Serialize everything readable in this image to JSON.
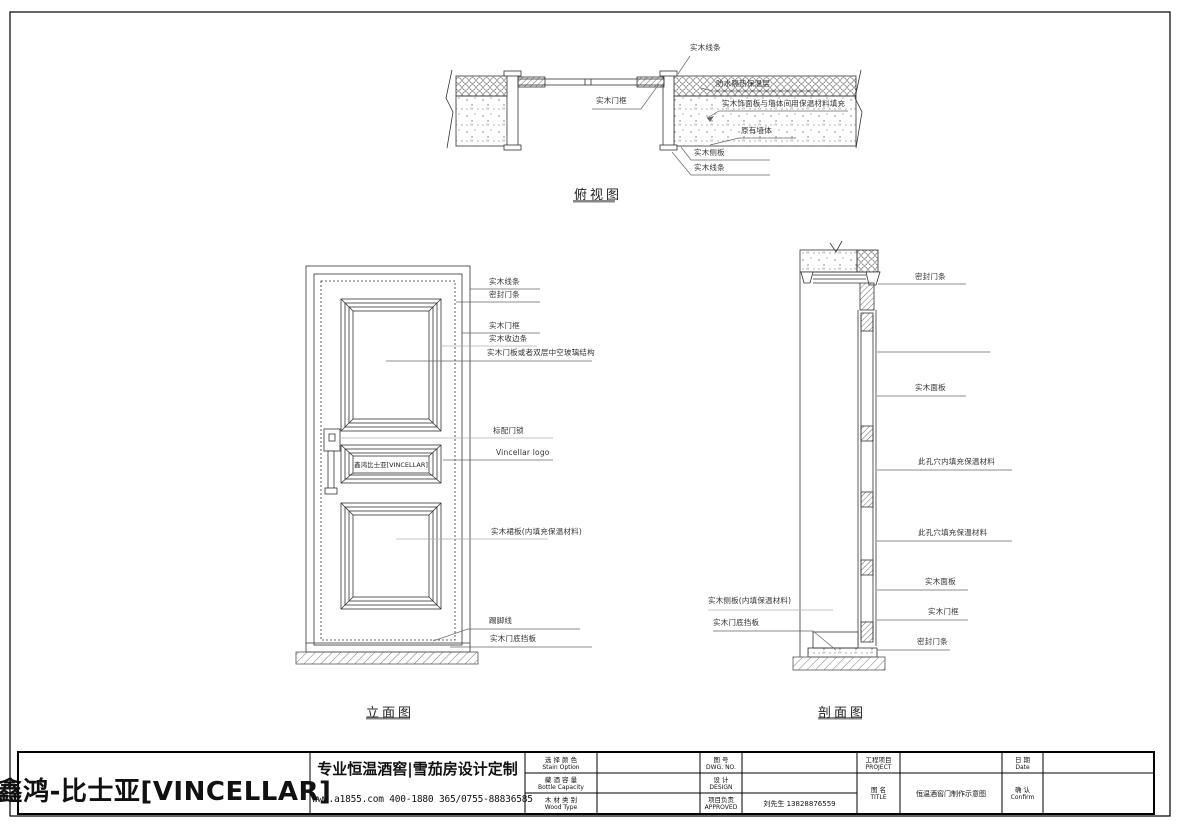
{
  "top_view": {
    "title": "俯视图",
    "labels": {
      "trim_top": "实木线条",
      "waterproof_insulation": "防水隔热保温层",
      "panel_gap_fill": "实木饰面板与墙体间用保温材料填充",
      "original_wall": "原有墙体",
      "side_panel": "实木侧板",
      "trim_bottom": "实木线条",
      "door_frame": "实木门框"
    }
  },
  "elevation": {
    "title": "立面图",
    "door_logo": "鑫鸿比士亚[VINCELLAR]",
    "labels": {
      "trim": "实木线条",
      "seal_strip": "密封门条",
      "door_frame": "实木门框",
      "edge_trim": "实木收边条",
      "panel_or_glass": "实木门板或者双层中空玻璃结构",
      "lock": "标配门锁",
      "logo": "Vincellar logo",
      "lower_panel": "实木裙板(内填充保温材料)",
      "skirting": "踢脚线",
      "bottom_board": "实木门底挡板"
    }
  },
  "section": {
    "title": "剖面图",
    "labels": {
      "seal_strip_top": "密封门条",
      "face_panel_top": "实木面板",
      "cavity_fill_1": "此孔穴内填充保温材料",
      "cavity_fill_2": "此孔穴填充保温材料",
      "face_panel_bottom": "实木面板",
      "door_frame": "实木门框",
      "seal_strip_bottom": "密封门条",
      "side_panel_fill": "实木侧板(内填保温材料)",
      "bottom_board": "实木门底挡板"
    }
  },
  "title_block": {
    "company": "鑫鸿-比士亚[VINCELLAR]",
    "slogan": "专业恒温酒窖|雪茄房设计定制",
    "contact": "www.a1855.com 400-1880 365/0755-88836585",
    "fields": {
      "stain_cn": "选 择 颜 色",
      "stain_en": "Stain Option",
      "bottle_cn": "藏 酒 容 量",
      "bottle_en": "Bottle Capacity",
      "wood_cn": "木 材 类 别",
      "wood_en": "Wood Type",
      "dwg_cn": "图 号",
      "dwg_en": "DWG. NO.",
      "design_cn": "设 计",
      "design_en": "DESIGN",
      "approved_cn": "项目负责",
      "approved_en": "APPROVED",
      "approved_value": "刘先生 13828876559",
      "project_cn": "工程项目",
      "project_en": "PROJECT",
      "title_cn": "图 名",
      "title_en": "TITLE",
      "title_value": "恒温酒窖门制作示意图",
      "date_cn": "日 期",
      "date_en": "Date",
      "confirm_cn": "确 认",
      "confirm_en": "Confirm"
    }
  }
}
